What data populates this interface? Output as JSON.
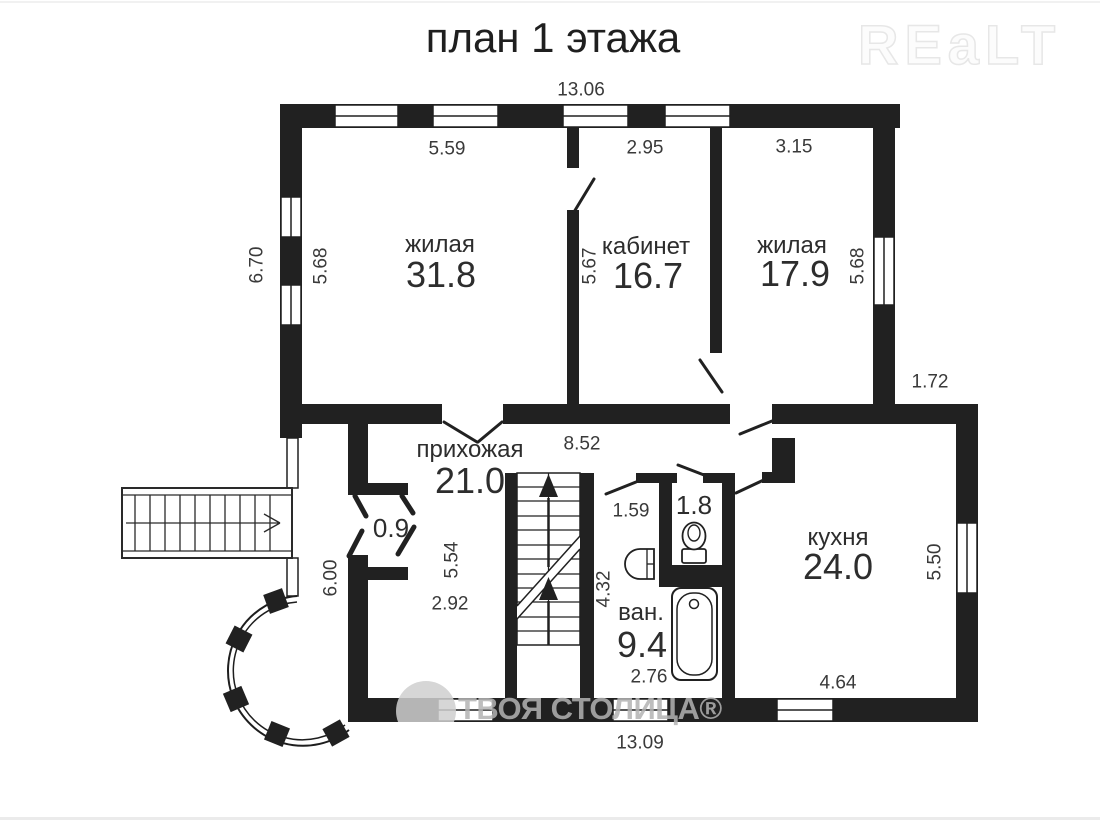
{
  "header": {
    "title": "план 1 этажа",
    "logo": "REaLT"
  },
  "watermark": {
    "text": "ТВОЯ СТОЛИЦА®"
  },
  "rooms": {
    "living1": {
      "name": "жилая",
      "area": "31.8"
    },
    "office": {
      "name": "кабинет",
      "area": "16.7"
    },
    "living2": {
      "name": "жилая",
      "area": "17.9"
    },
    "hall": {
      "name": "прихожая",
      "area": "21.0"
    },
    "kitchen": {
      "name": "кухня",
      "area": "24.0"
    },
    "bath": {
      "name": "ван.",
      "area": "9.4"
    },
    "wc": {
      "area": "1.8"
    },
    "porch": {
      "area": "0.9"
    }
  },
  "dims": {
    "top_width": "13.06",
    "bottom_width": "13.09",
    "left_height": "6.70",
    "living1_w": "5.59",
    "living1_h": "5.68",
    "office_w": "2.95",
    "office_h": "5.67",
    "living2_w": "3.15",
    "living2_h": "5.68",
    "right_step": "1.72",
    "hall_w": "8.52",
    "hall_h": "6.00",
    "hall_inner_h": "5.54",
    "hall_inner_w": "2.92",
    "bath_door_w": "1.59",
    "bath_h": "4.32",
    "bath_w": "2.76",
    "kitchen_h": "5.50",
    "kitchen_w": "4.64"
  }
}
